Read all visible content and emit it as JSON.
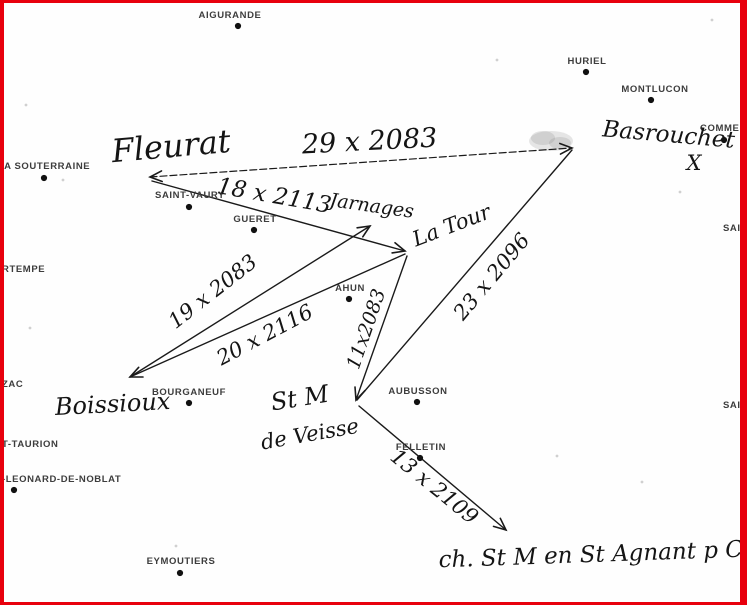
{
  "frame": {
    "border_color": "#e8000d",
    "background": "#fefefe",
    "width": 747,
    "height": 605
  },
  "map": {
    "printed_places": [
      {
        "name": "AIGURANDE",
        "label_x": 230,
        "label_y": 18,
        "anchor": "middle",
        "dot_x": 238,
        "dot_y": 26
      },
      {
        "name": "HURIEL",
        "label_x": 587,
        "label_y": 64,
        "anchor": "middle",
        "dot_x": 586,
        "dot_y": 72
      },
      {
        "name": "MONTLUCON",
        "label_x": 655,
        "label_y": 92,
        "anchor": "middle",
        "dot_x": 651,
        "dot_y": 100
      },
      {
        "name": "COMMENT",
        "label_x": 700,
        "label_y": 131,
        "anchor": "start",
        "dot_x": 724,
        "dot_y": 140,
        "clipped": true
      },
      {
        "name": "LA SOUTERRAINE",
        "label_x": 44,
        "label_y": 169,
        "anchor": "middle",
        "dot_x": 44,
        "dot_y": 178
      },
      {
        "name": "SAINT-VAURY",
        "label_x": 190,
        "label_y": 198,
        "anchor": "middle",
        "dot_x": 189,
        "dot_y": 207
      },
      {
        "name": "GUERET",
        "label_x": 255,
        "label_y": 222,
        "anchor": "middle",
        "dot_x": 254,
        "dot_y": 230
      },
      {
        "name": "AHUN",
        "label_x": 350,
        "label_y": 291,
        "anchor": "middle",
        "dot_x": 349,
        "dot_y": 299
      },
      {
        "name": "BOURGANEUF",
        "label_x": 189,
        "label_y": 395,
        "anchor": "middle",
        "dot_x": 189,
        "dot_y": 403
      },
      {
        "name": "AUBUSSON",
        "label_x": 418,
        "label_y": 394,
        "anchor": "middle",
        "dot_x": 417,
        "dot_y": 402
      },
      {
        "name": "FELLETIN",
        "label_x": 421,
        "label_y": 450,
        "anchor": "middle",
        "dot_x": 420,
        "dot_y": 458
      },
      {
        "name": "EYMOUTIERS",
        "label_x": 181,
        "label_y": 564,
        "anchor": "middle",
        "dot_x": 180,
        "dot_y": 573
      },
      {
        "name": "RTEMPE",
        "label_x": 2,
        "label_y": 272,
        "anchor": "start",
        "clipped": true
      },
      {
        "name": "ZAC",
        "label_x": 2,
        "label_y": 387,
        "anchor": "start",
        "clipped": true
      },
      {
        "name": "T-TAURION",
        "label_x": 2,
        "label_y": 447,
        "anchor": "start",
        "clipped": true
      },
      {
        "name": "-LEONARD-DE-NOBLAT",
        "label_x": 2,
        "label_y": 482,
        "anchor": "start",
        "dot_x": 14,
        "dot_y": 490,
        "clipped": true
      },
      {
        "name": "SAIN",
        "label_x": 723,
        "label_y": 231,
        "anchor": "start",
        "clipped": true
      },
      {
        "name": "SAIN",
        "label_x": 723,
        "label_y": 408,
        "anchor": "start",
        "clipped": true
      }
    ],
    "handwritten_labels": [
      {
        "text": "Fleurat",
        "x": 172,
        "y": 157,
        "size": 32,
        "rotate": -5
      },
      {
        "text": "29 x 2083",
        "x": 370,
        "y": 150,
        "size": 27,
        "rotate": -3
      },
      {
        "text": "Basrouchet",
        "x": 668,
        "y": 142,
        "size": 23,
        "rotate": 5
      },
      {
        "text": "X",
        "x": 694,
        "y": 170,
        "size": 21,
        "rotate": 0
      },
      {
        "text": "18 x 2113",
        "x": 273,
        "y": 203,
        "size": 23,
        "rotate": 10
      },
      {
        "text": "Jarnages",
        "x": 371,
        "y": 212,
        "size": 19,
        "rotate": 8
      },
      {
        "text": "La Tour",
        "x": 454,
        "y": 232,
        "size": 21,
        "rotate": -21
      },
      {
        "text": "19 x 2083",
        "x": 217,
        "y": 297,
        "size": 21,
        "rotate": -38
      },
      {
        "text": "20 x 2116",
        "x": 268,
        "y": 341,
        "size": 21,
        "rotate": -28
      },
      {
        "text": "11x2083",
        "x": 372,
        "y": 331,
        "size": 19,
        "rotate": -71
      },
      {
        "text": "23 x 2096",
        "x": 497,
        "y": 281,
        "size": 21,
        "rotate": -50
      },
      {
        "text": "Boissioux",
        "x": 113,
        "y": 412,
        "size": 24,
        "rotate": -3
      },
      {
        "text": "St M",
        "x": 301,
        "y": 406,
        "size": 24,
        "rotate": -9
      },
      {
        "text": "de Veisse",
        "x": 311,
        "y": 441,
        "size": 21,
        "rotate": -10
      },
      {
        "text": "13 x 2109",
        "x": 430,
        "y": 492,
        "size": 21,
        "rotate": 39
      },
      {
        "text": "ch. St M en St Agnant p C",
        "x": 591,
        "y": 562,
        "size": 23,
        "rotate": -2
      }
    ],
    "survey_lines": [
      {
        "name": "fleurat-basrouchet",
        "x1": 150,
        "y1": 177,
        "x2": 572,
        "y2": 148,
        "arrow_start": true,
        "arrow_end": true,
        "dashed": true
      },
      {
        "name": "fleurat-latour",
        "x1": 152,
        "y1": 181,
        "x2": 405,
        "y2": 251,
        "arrow_start": false,
        "arrow_end": true,
        "dashed": false
      },
      {
        "name": "boissioux-jarnages",
        "x1": 130,
        "y1": 377,
        "x2": 370,
        "y2": 226,
        "arrow_start": false,
        "arrow_end": true,
        "dashed": false
      },
      {
        "name": "latour-boissioux",
        "x1": 405,
        "y1": 254,
        "x2": 130,
        "y2": 377,
        "arrow_start": false,
        "arrow_end": true,
        "dashed": false
      },
      {
        "name": "latour-stm",
        "x1": 407,
        "y1": 256,
        "x2": 356,
        "y2": 400,
        "arrow_start": false,
        "arrow_end": true,
        "dashed": false
      },
      {
        "name": "stm-basrouchet",
        "x1": 357,
        "y1": 400,
        "x2": 572,
        "y2": 150,
        "arrow_start": false,
        "arrow_end": false,
        "dashed": false
      },
      {
        "name": "stm-stagnant",
        "x1": 359,
        "y1": 406,
        "x2": 506,
        "y2": 530,
        "arrow_start": false,
        "arrow_end": true,
        "dashed": false
      }
    ],
    "smudge": {
      "x": 551,
      "y": 141,
      "rx": 22,
      "ry": 10
    },
    "noise_specks": [
      {
        "x": 712,
        "y": 20
      },
      {
        "x": 497,
        "y": 60
      },
      {
        "x": 26,
        "y": 105
      },
      {
        "x": 63,
        "y": 180
      },
      {
        "x": 680,
        "y": 192
      },
      {
        "x": 557,
        "y": 456
      },
      {
        "x": 642,
        "y": 482
      },
      {
        "x": 176,
        "y": 546
      },
      {
        "x": 30,
        "y": 328
      }
    ],
    "ink_color": "#1a1a1a",
    "dot_color": "#111111"
  }
}
